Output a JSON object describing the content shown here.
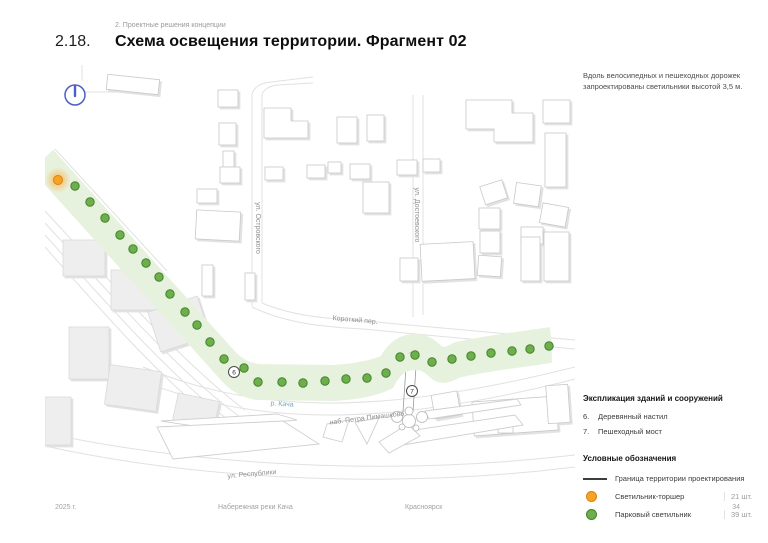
{
  "page": {
    "breadcrumb": "2. Проектные решения концепции",
    "section_number": "2.18.",
    "title": "Схема освещения территории. Фрагмент 02",
    "note": "Вдоль велосипедных и пешеходных дорожек запроектированы светильники высотой 3,5 м.",
    "footer": {
      "year": "2025 г.",
      "project": "Набережная реки Кача",
      "city": "Красноярск",
      "page_number": "34"
    }
  },
  "map": {
    "labels": {
      "ostrovskogo": "ул. Островского",
      "dostoevskogo": "ул. Достоевского",
      "korotkiy": "Короткий пер.",
      "kacha_river": "р. Кача",
      "naberezhnaya": "наб. Петра Пимашкова",
      "respubliki": "ул. Республики"
    },
    "markers": {
      "decking": "6",
      "bridge": "7"
    },
    "north_icon": "compass-north",
    "colors": {
      "torch_fill": "#F7A325",
      "torch_stroke": "#D9820F",
      "park_fill": "#6CAF4C",
      "park_stroke": "#45822C",
      "boundary": "#3E3E3E",
      "corridor_band": "#E7F2DE",
      "compass_blue": "#4A5FC9"
    },
    "torch_light": {
      "x": 13,
      "y": 115
    },
    "park_lights": [
      [
        30,
        121
      ],
      [
        45,
        137
      ],
      [
        60,
        153
      ],
      [
        75,
        170
      ],
      [
        88,
        184
      ],
      [
        101,
        198
      ],
      [
        114,
        212
      ],
      [
        125,
        229
      ],
      [
        140,
        247
      ],
      [
        152,
        260
      ],
      [
        165,
        277
      ],
      [
        179,
        294
      ],
      [
        199,
        303
      ],
      [
        213,
        317
      ],
      [
        237,
        317
      ],
      [
        258,
        318
      ],
      [
        280,
        316
      ],
      [
        301,
        314
      ],
      [
        322,
        313
      ],
      [
        341,
        308
      ],
      [
        355,
        292
      ],
      [
        370,
        290
      ],
      [
        387,
        297
      ],
      [
        407,
        294
      ],
      [
        426,
        291
      ],
      [
        446,
        288
      ],
      [
        467,
        286
      ],
      [
        485,
        284
      ],
      [
        504,
        281
      ]
    ]
  },
  "legend": {
    "explication_title": "Экспликация зданий и сооружений",
    "explication_items": [
      {
        "num": "6.",
        "label": "Деревянный настил"
      },
      {
        "num": "7.",
        "label": "Пешеходный мост"
      }
    ],
    "symbols_title": "Условные обозначения",
    "symbols": {
      "boundary": {
        "label": "Граница территории проектирования"
      },
      "torch": {
        "label": "Светильник-торшер",
        "count": "21 шт."
      },
      "park": {
        "label": "Парковый светильник",
        "count": "39 шт."
      }
    }
  }
}
